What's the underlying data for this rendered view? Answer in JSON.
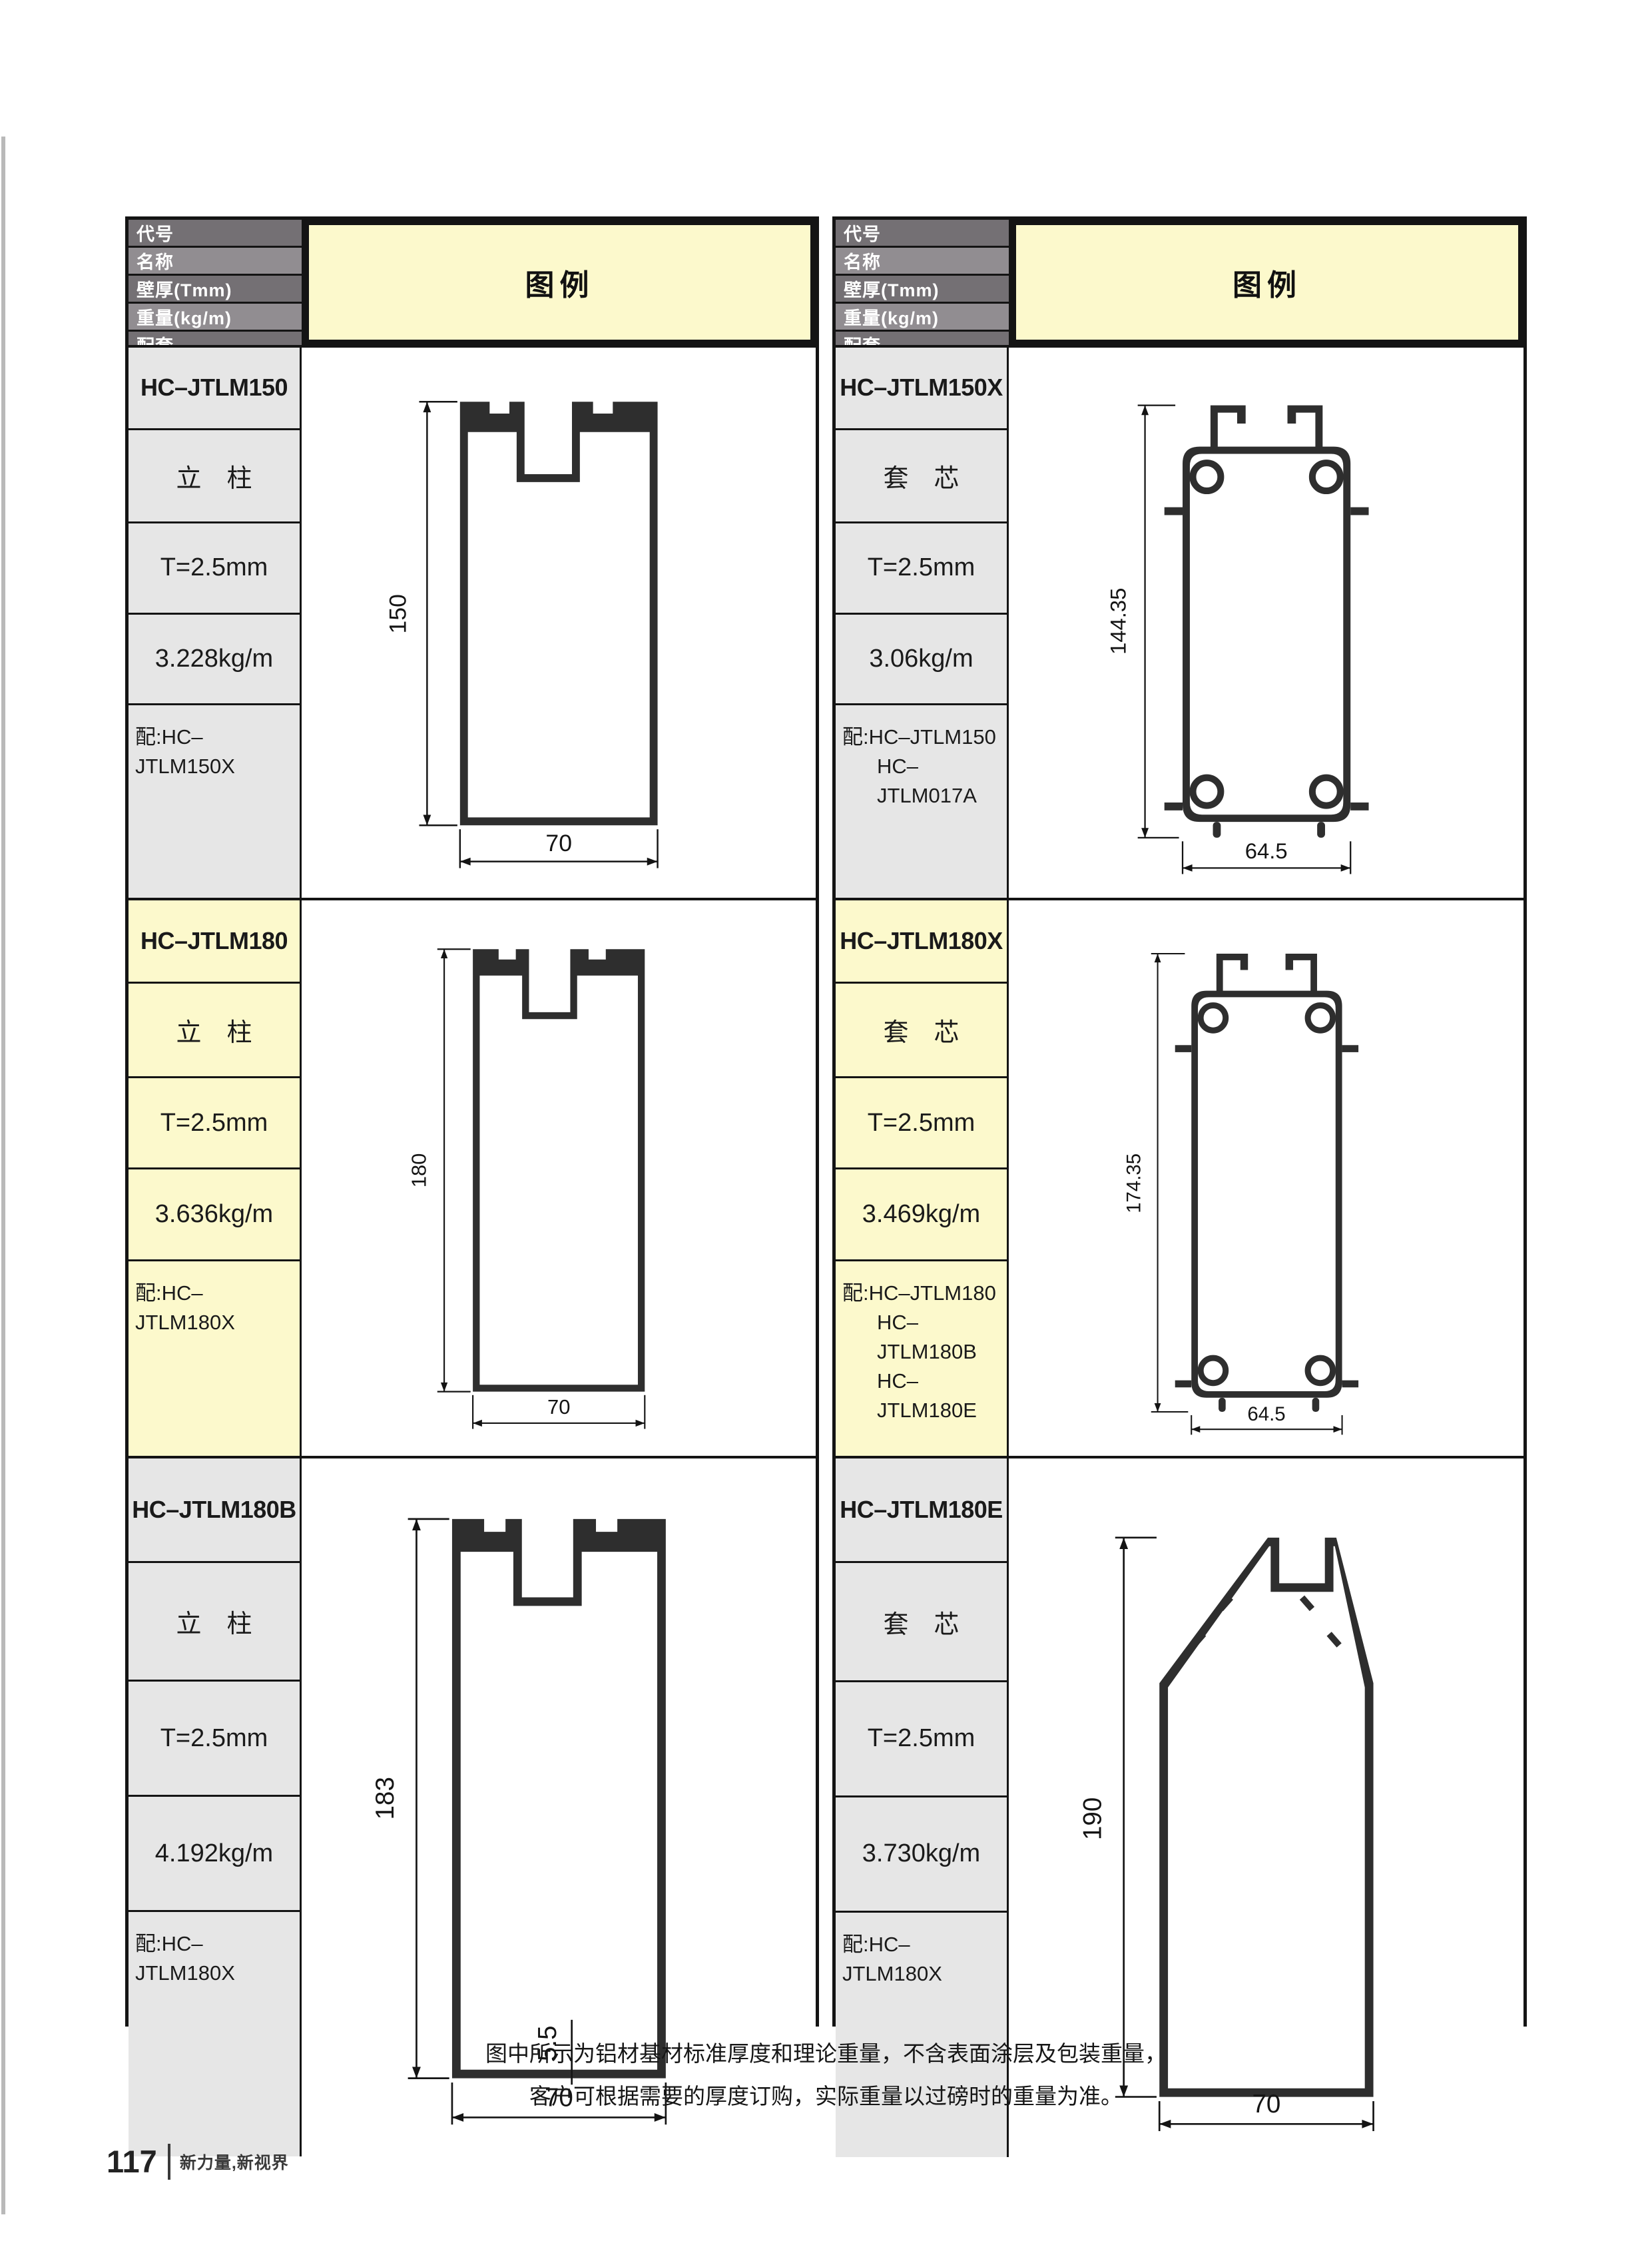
{
  "page": {
    "footer_note_line1": "图中所示为铝材基材标准厚度和理论重量，不含表面涂层及包装重量，",
    "footer_note_line2": "客户可根据需要的厚度订购，实际重量以过磅时的重量为准。",
    "page_number": "117",
    "tagline": "新力量,新视界"
  },
  "legend_label": "图例",
  "header_labels": [
    "代号",
    "名称",
    "壁厚(Tmm)",
    "重量(kg/m)",
    "配套"
  ],
  "colors": {
    "legend_yellow": "#fcf9cc",
    "highlight_row_yellow": "#fcf9cc",
    "cell_gray": "#e6e6e6",
    "header_gray_dark": "#747074",
    "header_gray_light": "#918d91",
    "border_black": "#141414",
    "profile_wall": "#2e2e2e"
  },
  "entries": [
    {
      "code": "HC–JTLM150",
      "name": "立　柱",
      "thickness": "T=2.5mm",
      "weight": "3.228kg/m",
      "match": [
        "配:HC–JTLM150X"
      ],
      "drawing": {
        "type": "mullion",
        "height_label": "150",
        "width_label": "70"
      }
    },
    {
      "code": "HC–JTLM150X",
      "name": "套　芯",
      "thickness": "T=2.5mm",
      "weight": "3.06kg/m",
      "match": [
        "配:HC–JTLM150",
        "HC–JTLM017A"
      ],
      "drawing": {
        "type": "core",
        "height_label": "144.35",
        "width_label": "64.5"
      }
    },
    {
      "code": "HC–JTLM180",
      "name": "立　柱",
      "thickness": "T=2.5mm",
      "weight": "3.636kg/m",
      "match": [
        "配:HC–JTLM180X"
      ],
      "drawing": {
        "type": "mullion",
        "height_label": "180",
        "width_label": "70"
      }
    },
    {
      "code": "HC–JTLM180X",
      "name": "套　芯",
      "thickness": "T=2.5mm",
      "weight": "3.469kg/m",
      "match": [
        "配:HC–JTLM180",
        "HC–JTLM180B",
        "HC–JTLM180E"
      ],
      "drawing": {
        "type": "core",
        "height_label": "174.35",
        "width_label": "64.5"
      }
    },
    {
      "code": "HC–JTLM180B",
      "name": "立　柱",
      "thickness": "T=2.5mm",
      "weight": "4.192kg/m",
      "match": [
        "配:HC–JTLM180X"
      ],
      "drawing": {
        "type": "mullion-bottom",
        "height_label": "183",
        "width_label": "70",
        "extra_label": "5.5"
      }
    },
    {
      "code": "HC–JTLM180E",
      "name": "套　芯",
      "thickness": "T=2.5mm",
      "weight": "3.730kg/m",
      "match": [
        "配:HC–JTLM180X"
      ],
      "drawing": {
        "type": "peaked",
        "height_label": "190",
        "width_label": "70"
      }
    }
  ]
}
